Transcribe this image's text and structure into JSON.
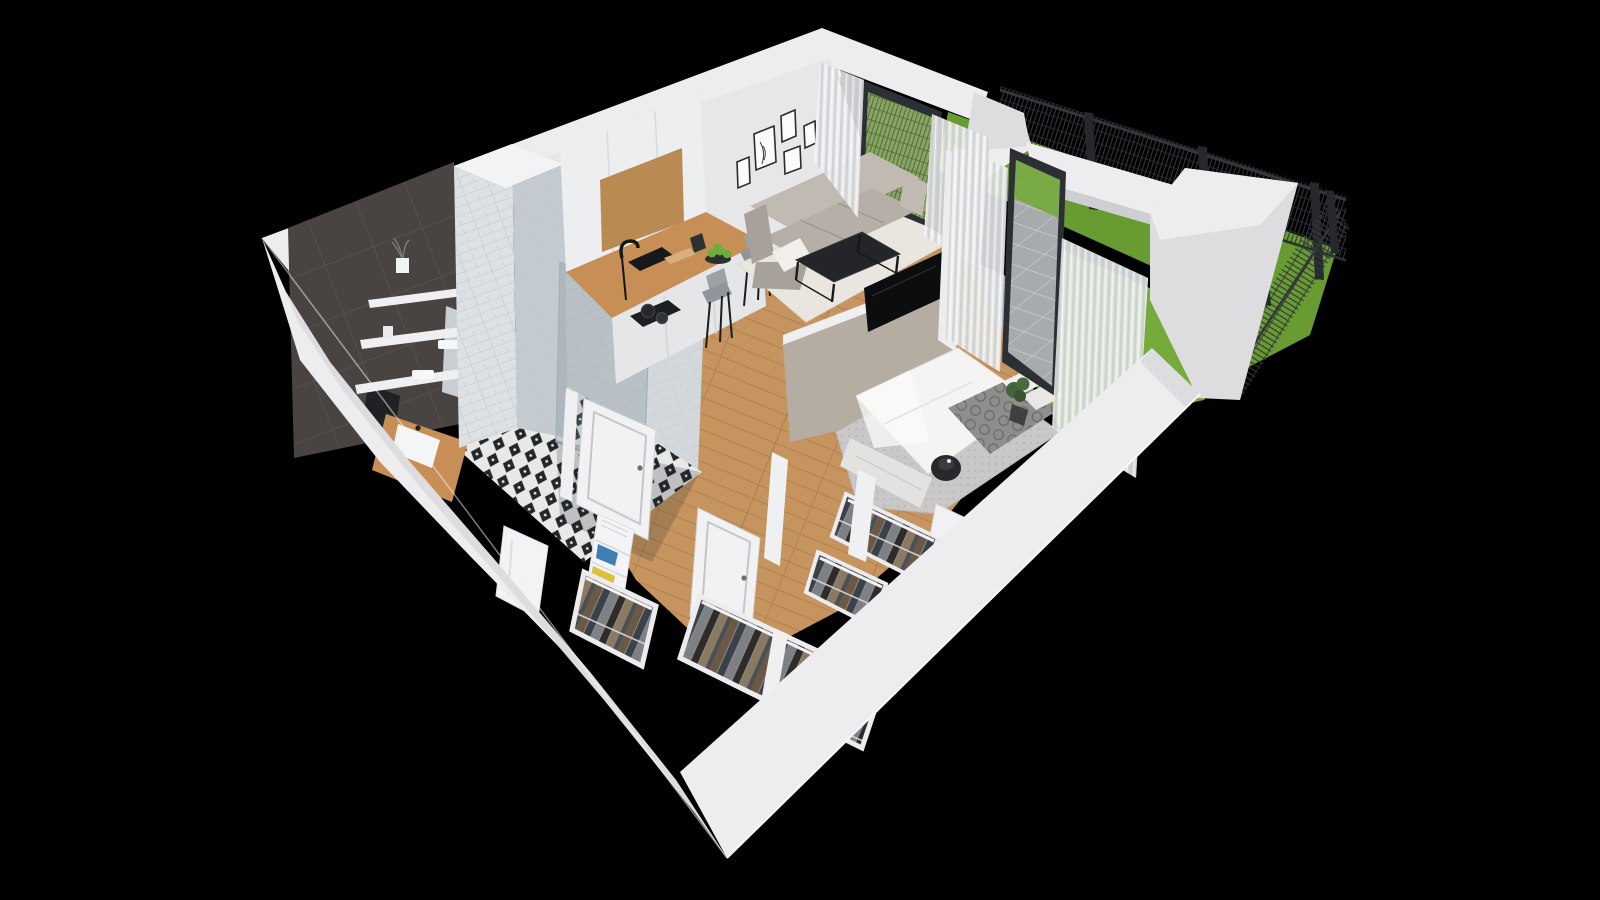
{
  "scene": {
    "kind": "isometric-3d-apartment-floorplan-render",
    "background": "black",
    "rooms": [
      {
        "name": "bathroom",
        "features": [
          "dark-tile-feature-wall",
          "three-wall-shelves",
          "plant-pot",
          "towels",
          "wall-hung-toilet",
          "wood-vanity-with-white-sink",
          "glass-shower",
          "white-subway-tile-column",
          "black-white-patterned-tile-floor",
          "open-white-door"
        ]
      },
      {
        "name": "kitchen",
        "features": [
          "tall-white-cabinets",
          "wood-upper-panel",
          "black-sink",
          "black-faucet",
          "knife-block",
          "cutting-board",
          "cooktop-with-two-pots",
          "l-shaped-wood-counter",
          "breakfast-bar",
          "two-gray-bar-stools",
          "bowl-of-green-apples"
        ]
      },
      {
        "name": "living-room",
        "features": [
          "gallery-wall-five-frames",
          "corner-sofa-light-gray",
          "white-throw-blanket",
          "black-metal-coffee-table",
          "white-rug",
          "flat-tv-on-half-wall",
          "sliding-glass-door",
          "sheer-curtains"
        ]
      },
      {
        "name": "bedroom",
        "features": [
          "double-bed-white-duvet",
          "patterned-gray-blanket",
          "white-pillows",
          "gray-rug",
          "black-pendant-lamp",
          "white-bedside-table",
          "open-wardrobe-with-clothes",
          "glass-door-to-garden",
          "sheer-curtains",
          "potted-plant"
        ]
      },
      {
        "name": "hallway",
        "features": [
          "wood-plank-floor",
          "open-white-interior-doors",
          "white-shelf-with-books",
          "coat-closet-with-clothes",
          "white-appliance-cabinet"
        ]
      },
      {
        "name": "walk-in-closet",
        "features": [
          "two-rows-hanging-clothes",
          "white-rails-and-dividers"
        ]
      },
      {
        "name": "garden",
        "features": [
          "lawn-grass",
          "concrete-paver-path",
          "dark-mesh-fence",
          "fence-posts",
          "white-boundary-walls"
        ]
      }
    ]
  },
  "colors": {
    "background": "#000000",
    "wallLight": "#ededef",
    "wallMid": "#dddde0",
    "wallShade": "#cfcfd3",
    "wallInner": "#e7e7e9",
    "wallTan": "#b5aca2",
    "doorWhite": "#f2f2f4",
    "darkTile": "#494441",
    "subwayTile": "#dde1e4",
    "showerWall": "#d3d8dc",
    "glassTint": "#7c8c96",
    "woodFloor": "#c6945f",
    "woodCounter": "#c78f55",
    "woodPanel": "#b98a52",
    "cabinetWhite": "#eceeef",
    "baseCabinet": "#e4e6e8",
    "sofa": "#b6afa7",
    "sofaLight": "#c1bab2",
    "sofaShade": "#a8a199",
    "rugLiving": "#e9e6e0",
    "rugBedroom": "#cac8c7",
    "tableBlack": "#232528",
    "tvBlack": "#0c0d0f",
    "bedWhite": "#f5f4f2",
    "bedFrame": "#e3e2e0",
    "blanket": "#8f8e8c",
    "grass": "#76aa3b",
    "grassDark": "#689c33",
    "paver": "#a6abad",
    "fence": "#31353b",
    "fencePost": "#26282c",
    "curtain": "#eceded",
    "toiletWhite": "#f3f5f6",
    "greenFruit": "#6cae3a",
    "plantGreen": "#44633a",
    "bookBlue": "#3f7fb5",
    "bookYellow": "#dcc13e",
    "shelfWhite": "#f4f4f6",
    "tileFloorBase": "#e8e8e6"
  }
}
